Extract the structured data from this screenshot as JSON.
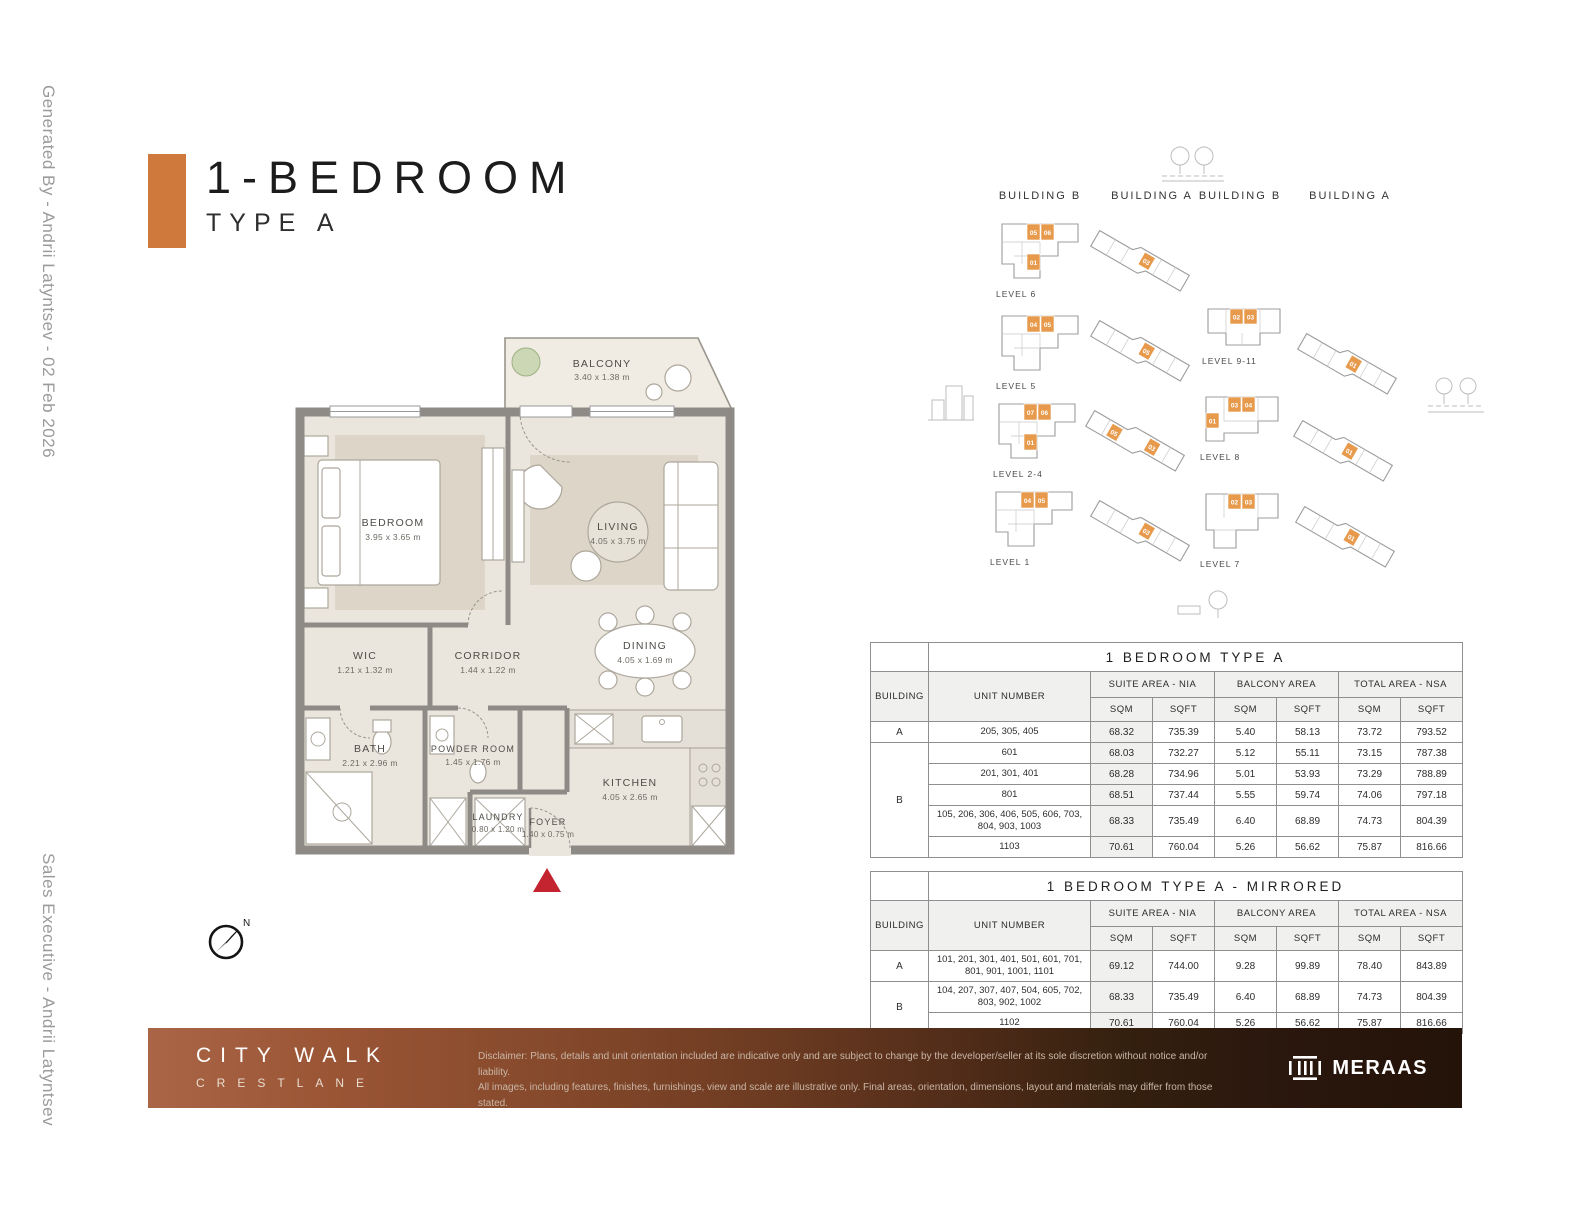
{
  "meta": {
    "generated_by": "Generated By - Andrii Latyntsev - 02 Feb 2026",
    "sales_executive": "Sales Executive - Andrii Latyntsev"
  },
  "title": {
    "main": "1-BEDROOM",
    "sub": "TYPE A"
  },
  "colors": {
    "accent_orange": "#CF7A3C",
    "unit_highlight": "#E79A4C",
    "entry_marker_red": "#C42430",
    "footer_left": "#A96546",
    "footer_right": "#241309"
  },
  "floorplan": {
    "compass_label": "N",
    "rooms": [
      {
        "name": "BALCONY",
        "dims": "3.40 x 1.38 m"
      },
      {
        "name": "BEDROOM",
        "dims": "3.95 x 3.65 m"
      },
      {
        "name": "LIVING",
        "dims": "4.05 x 3.75 m"
      },
      {
        "name": "WIC",
        "dims": "1.21 x 1.32 m"
      },
      {
        "name": "CORRIDOR",
        "dims": "1.44 x 1.22 m"
      },
      {
        "name": "DINING",
        "dims": "4.05 x 1.69 m"
      },
      {
        "name": "BATH",
        "dims": "2.21 x 2.96 m"
      },
      {
        "name": "POWDER ROOM",
        "dims": "1.45 x 1.76 m"
      },
      {
        "name": "KITCHEN",
        "dims": "4.05 x 2.65 m"
      },
      {
        "name": "LAUNDRY",
        "dims": "0.80 x 1.20 m"
      },
      {
        "name": "FOYER",
        "dims": "1.40 x 0.75 m"
      }
    ]
  },
  "buildings": {
    "column_headers": [
      "BUILDING B",
      "BUILDING A",
      "BUILDING B",
      "BUILDING A"
    ],
    "building_b_left": [
      {
        "level": "LEVEL 6",
        "units": [
          "05",
          "06",
          "01"
        ]
      },
      {
        "level": "LEVEL 5",
        "units": [
          "04",
          "05",
          ""
        ]
      },
      {
        "level": "LEVEL 2-4",
        "units": [
          "07",
          "06",
          "01"
        ]
      },
      {
        "level": "LEVEL 1",
        "units": [
          "04",
          "05",
          ""
        ]
      }
    ],
    "building_a_left": [
      {
        "units": [
          "03"
        ]
      },
      {
        "units": [
          "05"
        ]
      },
      {
        "units": [
          "05",
          "03"
        ]
      },
      {
        "units": [
          "03"
        ]
      }
    ],
    "building_b_right": [
      {
        "level": "LEVEL 9-11",
        "units": [
          "02",
          "03",
          ""
        ]
      },
      {
        "level": "LEVEL 8",
        "units": [
          "03",
          "04",
          "01"
        ]
      },
      {
        "level": "LEVEL 7",
        "units": [
          "02",
          "03",
          ""
        ]
      }
    ],
    "building_a_right": [
      {
        "units": [
          "01"
        ]
      },
      {
        "units": [
          "01"
        ]
      },
      {
        "units": [
          "01"
        ]
      }
    ]
  },
  "tables": [
    {
      "title": "1 BEDROOM TYPE A",
      "headers": {
        "building": "BUILDING",
        "unit": "UNIT NUMBER",
        "suite": "SUITE AREA - NIA",
        "balcony": "BALCONY AREA",
        "total": "TOTAL AREA - NSA",
        "sqm": "SQM",
        "sqft": "SQFT"
      },
      "building_a_label": "A",
      "building_b_label": "B",
      "rows": [
        {
          "unit": "205, 305, 405",
          "suite_sqm": "68.32",
          "suite_sqft": "735.39",
          "bal_sqm": "5.40",
          "bal_sqft": "58.13",
          "tot_sqm": "73.72",
          "tot_sqft": "793.52"
        },
        {
          "unit": "601",
          "suite_sqm": "68.03",
          "suite_sqft": "732.27",
          "bal_sqm": "5.12",
          "bal_sqft": "55.11",
          "tot_sqm": "73.15",
          "tot_sqft": "787.38"
        },
        {
          "unit": "201, 301, 401",
          "suite_sqm": "68.28",
          "suite_sqft": "734.96",
          "bal_sqm": "5.01",
          "bal_sqft": "53.93",
          "tot_sqm": "73.29",
          "tot_sqft": "788.89"
        },
        {
          "unit": "801",
          "suite_sqm": "68.51",
          "suite_sqft": "737.44",
          "bal_sqm": "5.55",
          "bal_sqft": "59.74",
          "tot_sqm": "74.06",
          "tot_sqft": "797.18"
        },
        {
          "unit": "105, 206, 306, 406, 505, 606, 703, 804, 903, 1003",
          "suite_sqm": "68.33",
          "suite_sqft": "735.49",
          "bal_sqm": "6.40",
          "bal_sqft": "68.89",
          "tot_sqm": "74.73",
          "tot_sqft": "804.39"
        },
        {
          "unit": "1103",
          "suite_sqm": "70.61",
          "suite_sqft": "760.04",
          "bal_sqm": "5.26",
          "bal_sqft": "56.62",
          "tot_sqm": "75.87",
          "tot_sqft": "816.66"
        }
      ]
    },
    {
      "title": "1 BEDROOM TYPE A - MIRRORED",
      "headers": {
        "building": "BUILDING",
        "unit": "UNIT NUMBER",
        "suite": "SUITE AREA - NIA",
        "balcony": "BALCONY AREA",
        "total": "TOTAL AREA - NSA",
        "sqm": "SQM",
        "sqft": "SQFT"
      },
      "building_a_label": "A",
      "building_b_label": "B",
      "rows": [
        {
          "unit": "101, 201, 301, 401, 501, 601, 701, 801, 901, 1001, 1101",
          "suite_sqm": "69.12",
          "suite_sqft": "744.00",
          "bal_sqm": "9.28",
          "bal_sqft": "99.89",
          "tot_sqm": "78.40",
          "tot_sqft": "843.89"
        },
        {
          "unit": "104, 207, 307, 407, 504, 605, 702, 803, 902, 1002",
          "suite_sqm": "68.33",
          "suite_sqft": "735.49",
          "bal_sqm": "6.40",
          "bal_sqft": "68.89",
          "tot_sqm": "74.73",
          "tot_sqft": "804.39"
        },
        {
          "unit": "1102",
          "suite_sqm": "70.61",
          "suite_sqft": "760.04",
          "bal_sqm": "5.26",
          "bal_sqft": "56.62",
          "tot_sqm": "75.87",
          "tot_sqft": "816.66"
        }
      ]
    }
  ],
  "footer": {
    "brand_main": "CITY WALK",
    "brand_sub": "CRESTLANE",
    "disclaimer_line1": "Disclaimer: Plans, details and unit orientation included are indicative only and are subject to change by the developer/seller at its sole discretion without notice and/or liability.",
    "disclaimer_line2": "All images, including features, finishes, furnishings, view and scale are illustrative only. Final areas, orientation, dimensions, layout and materials may differ from those stated.",
    "logo_text": "MERAAS"
  }
}
